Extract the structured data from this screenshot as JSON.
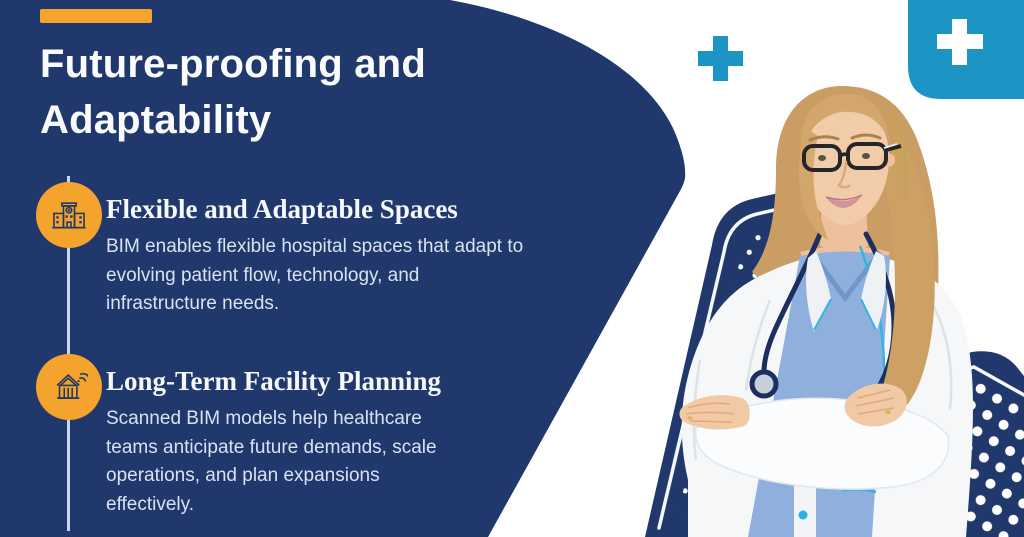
{
  "title": {
    "line1": "Future-proofing and",
    "line2": "Adaptability"
  },
  "sections": [
    {
      "heading": "Flexible and Adaptable Spaces",
      "icon": "hospital-building-icon",
      "body_lines": [
        "BIM enables flexible hospital spaces that adapt to",
        "evolving patient flow, technology, and",
        "infrastructure needs."
      ]
    },
    {
      "heading": "Long-Term Facility Planning",
      "icon": "smart-building-signal-icon",
      "body_lines": [
        "Scanned BIM models help healthcare",
        "teams anticipate future demands, scale",
        "operations, and plan expansions",
        "effectively."
      ]
    }
  ],
  "decor_icons": {
    "small_cross": "medical-cross-icon",
    "corner_badge_cross": "medical-cross-badge-icon"
  },
  "illustration": "female-doctor-arms-crossed-stethoscope",
  "colors": {
    "navy": "#20386B",
    "orange": "#F4A42C",
    "cyan": "#1D95C4",
    "title_text": "#FAFBFD",
    "heading_text": "#F5F8FC",
    "body_text": "#D9E2F1",
    "line_color": "#C9D5E8",
    "dot_color": "#FFFFFF"
  }
}
